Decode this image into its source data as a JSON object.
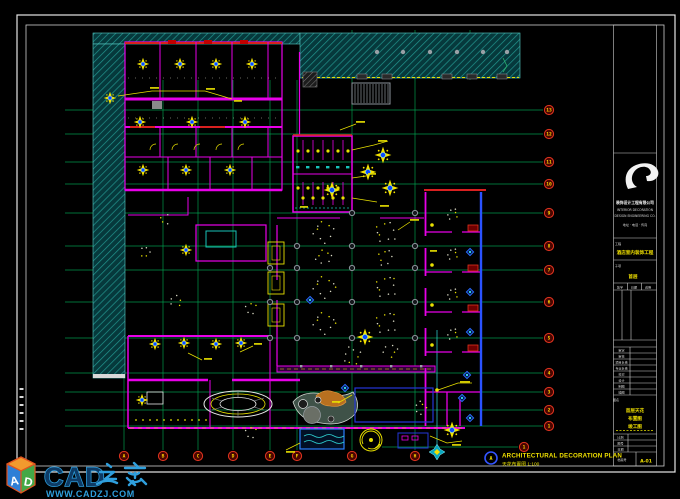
{
  "annotation": {
    "marker": "A",
    "title": "ARCHITECTURAL DECORATION PLAN",
    "subtitle": "天花布置图 1:100",
    "end_bubble": "1"
  },
  "grid": {
    "h": [
      {
        "y": 110,
        "label": "13"
      },
      {
        "y": 134,
        "label": "12"
      },
      {
        "y": 162,
        "label": "11"
      },
      {
        "y": 184,
        "label": "10"
      },
      {
        "y": 213,
        "label": "9"
      },
      {
        "y": 246,
        "label": "8"
      },
      {
        "y": 270,
        "label": "7"
      },
      {
        "y": 302,
        "label": "6"
      },
      {
        "y": 338,
        "label": "5"
      },
      {
        "y": 373,
        "label": "4"
      },
      {
        "y": 392,
        "label": "3"
      },
      {
        "y": 410,
        "label": "2"
      },
      {
        "y": 426,
        "label": "1"
      }
    ],
    "v": [
      {
        "x": 124,
        "label": "A",
        "y1": 80
      },
      {
        "x": 163,
        "label": "B",
        "y1": 80
      },
      {
        "x": 198,
        "label": "C",
        "y1": 80
      },
      {
        "x": 233,
        "label": "D",
        "y1": 80
      },
      {
        "x": 270,
        "label": "E",
        "y1": 80
      },
      {
        "x": 297,
        "label": "F",
        "y1": 80
      },
      {
        "x": 352,
        "label": "G",
        "y1": 30
      },
      {
        "x": 415,
        "label": "H",
        "y1": 30
      }
    ],
    "extra_h": {
      "y": 447,
      "x1": 382,
      "x2": 518
    },
    "inline_bubble": {
      "x": 524,
      "y": 447
    }
  },
  "titleblock": {
    "firm_name": "装饰设计工程有限公司",
    "firm_lines": [
      "INTERIOR DECORATION",
      "DESIGN ENGINEERING CO.",
      "地址 · 电话 · 传真"
    ],
    "project_label": "工程",
    "project_name": "酒店室内装饰工程",
    "subitem_label": "子项",
    "subitem_name": "首层",
    "approval_cells": [
      "签字",
      "日期",
      "说明"
    ],
    "staff_rows": [
      "审定",
      "审核",
      "项目负责",
      "专业负责",
      "校对",
      "设计",
      "制图",
      "描图"
    ],
    "drawing_label": "图名",
    "drawing_name_1": "首层天花",
    "drawing_name_2": "布置图",
    "note": "竣工图",
    "meta_rows": [
      "比例",
      "图号",
      "日期"
    ],
    "archive_label": "档案号",
    "sheet_no": "A-01"
  },
  "watermark": {
    "brand_latin": "CAD",
    "brand_cjk": "之家",
    "url": "WWW.CADZJ.COM",
    "cube_letters": [
      "A",
      "D"
    ],
    "brand_color": "#2f9fdd"
  },
  "plan": {
    "fans": [
      [
        143,
        64
      ],
      [
        180,
        64
      ],
      [
        216,
        64
      ],
      [
        252,
        64
      ],
      [
        110,
        98
      ],
      [
        140,
        122
      ],
      [
        192,
        122
      ],
      [
        245,
        122
      ],
      [
        143,
        170
      ],
      [
        186,
        170
      ],
      [
        230,
        170
      ],
      [
        186,
        250
      ],
      [
        155,
        344
      ],
      [
        184,
        343
      ],
      [
        216,
        344
      ],
      [
        241,
        343
      ],
      [
        142,
        400
      ]
    ],
    "big_lights": [
      [
        383,
        155
      ],
      [
        368,
        172
      ],
      [
        390,
        188
      ],
      [
        332,
        190
      ],
      [
        365,
        337
      ],
      [
        452,
        430
      ]
    ],
    "diamonds": [
      [
        470,
        252
      ],
      [
        470,
        292
      ],
      [
        470,
        332
      ],
      [
        467,
        375
      ],
      [
        462,
        398
      ],
      [
        470,
        418
      ],
      [
        345,
        388
      ],
      [
        310,
        300
      ]
    ],
    "nodes": [
      [
        270,
        268
      ],
      [
        297,
        268
      ],
      [
        352,
        268
      ],
      [
        415,
        268
      ],
      [
        270,
        302
      ],
      [
        297,
        302
      ],
      [
        352,
        302
      ],
      [
        415,
        302
      ],
      [
        297,
        338
      ],
      [
        352,
        338
      ],
      [
        415,
        338
      ],
      [
        297,
        246
      ],
      [
        352,
        246
      ],
      [
        415,
        246
      ],
      [
        352,
        213
      ],
      [
        415,
        213
      ],
      [
        270,
        338
      ]
    ],
    "clusters": [
      [
        324,
        232,
        13,
        9
      ],
      [
        386,
        232,
        13,
        9
      ],
      [
        324,
        258,
        10,
        7
      ],
      [
        386,
        258,
        10,
        7
      ],
      [
        324,
        287,
        13,
        10
      ],
      [
        386,
        287,
        13,
        10
      ],
      [
        324,
        323,
        13,
        10
      ],
      [
        386,
        323,
        13,
        10
      ],
      [
        352,
        356,
        11,
        8
      ],
      [
        452,
        214,
        7,
        6
      ],
      [
        452,
        254,
        7,
        6
      ],
      [
        452,
        294,
        7,
        6
      ],
      [
        452,
        334,
        7,
        6
      ],
      [
        176,
        300,
        8,
        5
      ],
      [
        146,
        252,
        7,
        5
      ],
      [
        250,
        308,
        8,
        5
      ],
      [
        390,
        350,
        9,
        6
      ],
      [
        420,
        408,
        8,
        6
      ],
      [
        250,
        432,
        8,
        5
      ],
      [
        166,
        220,
        7,
        4
      ]
    ],
    "leaders": [
      [
        118,
        96,
        152,
        91,
        205,
        91
      ],
      [
        205,
        91,
        232,
        99
      ],
      [
        352,
        150,
        374,
        145,
        388,
        141
      ],
      [
        352,
        178,
        366,
        176
      ],
      [
        352,
        198,
        377,
        202
      ],
      [
        438,
        390,
        458,
        383,
        472,
        383
      ],
      [
        352,
        395,
        338,
        403
      ],
      [
        300,
        443,
        286,
        450
      ],
      [
        430,
        436,
        447,
        443,
        462,
        441
      ],
      [
        188,
        353,
        202,
        360
      ],
      [
        240,
        352,
        253,
        346
      ],
      [
        398,
        230,
        410,
        222
      ],
      [
        340,
        130,
        356,
        124
      ]
    ],
    "blobs": [
      [
        150,
        87,
        9
      ],
      [
        206,
        88,
        9
      ],
      [
        234,
        100,
        8
      ],
      [
        378,
        140,
        9
      ],
      [
        368,
        173,
        8
      ],
      [
        380,
        205,
        9
      ],
      [
        460,
        381,
        10
      ],
      [
        332,
        401,
        8
      ],
      [
        286,
        451,
        9
      ],
      [
        452,
        444,
        9
      ],
      [
        204,
        358,
        8
      ],
      [
        254,
        343,
        8
      ],
      [
        410,
        219,
        9
      ],
      [
        356,
        121,
        9
      ],
      [
        300,
        206,
        8
      ],
      [
        430,
        250,
        7
      ]
    ]
  }
}
